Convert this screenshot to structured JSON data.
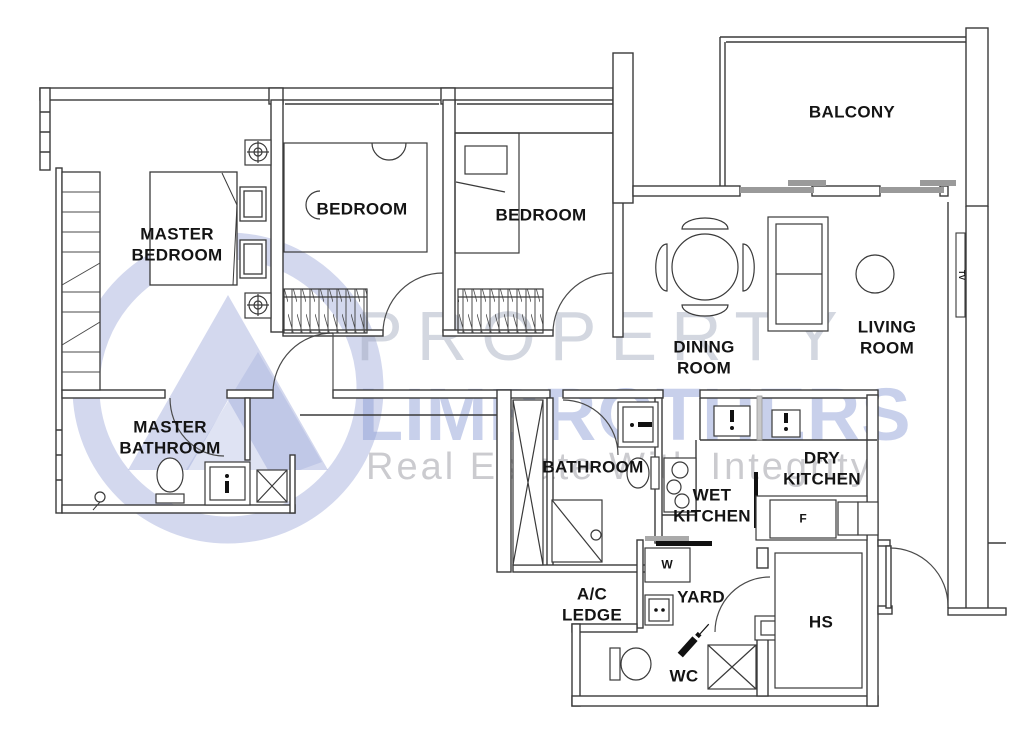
{
  "watermark": {
    "brand_top": "PROPERTY",
    "brand_bottom": "LIMBROTHERS",
    "tagline": "Real Estate With Integrity"
  },
  "colors": {
    "wall": "#3a3a3a",
    "label": "#141414",
    "sliding_door_gray": "#9a9a9a",
    "watermark_blue": "#8c9cd6",
    "watermark_gray": "#9ea7ba"
  },
  "rooms": [
    {
      "id": "master-bedroom",
      "label": "MASTER\nBEDROOM"
    },
    {
      "id": "bedroom-1",
      "label": "BEDROOM"
    },
    {
      "id": "bedroom-2",
      "label": "BEDROOM"
    },
    {
      "id": "balcony",
      "label": "BALCONY"
    },
    {
      "id": "dining-room",
      "label": "DINING\nROOM"
    },
    {
      "id": "living-room",
      "label": "LIVING\nROOM"
    },
    {
      "id": "master-bathroom",
      "label": "MASTER\nBATHROOM"
    },
    {
      "id": "bathroom",
      "label": "BATHROOM"
    },
    {
      "id": "wet-kitchen",
      "label": "WET\nKITCHEN"
    },
    {
      "id": "dry-kitchen",
      "label": "DRY\nKITCHEN"
    },
    {
      "id": "ac-ledge",
      "label": "A/C\nLEDGE"
    },
    {
      "id": "yard",
      "label": "YARD"
    },
    {
      "id": "wc",
      "label": "WC"
    },
    {
      "id": "hs",
      "label": "HS"
    },
    {
      "id": "washer",
      "label": "W"
    },
    {
      "id": "fridge",
      "label": "F"
    },
    {
      "id": "tv",
      "label": "TV"
    }
  ]
}
